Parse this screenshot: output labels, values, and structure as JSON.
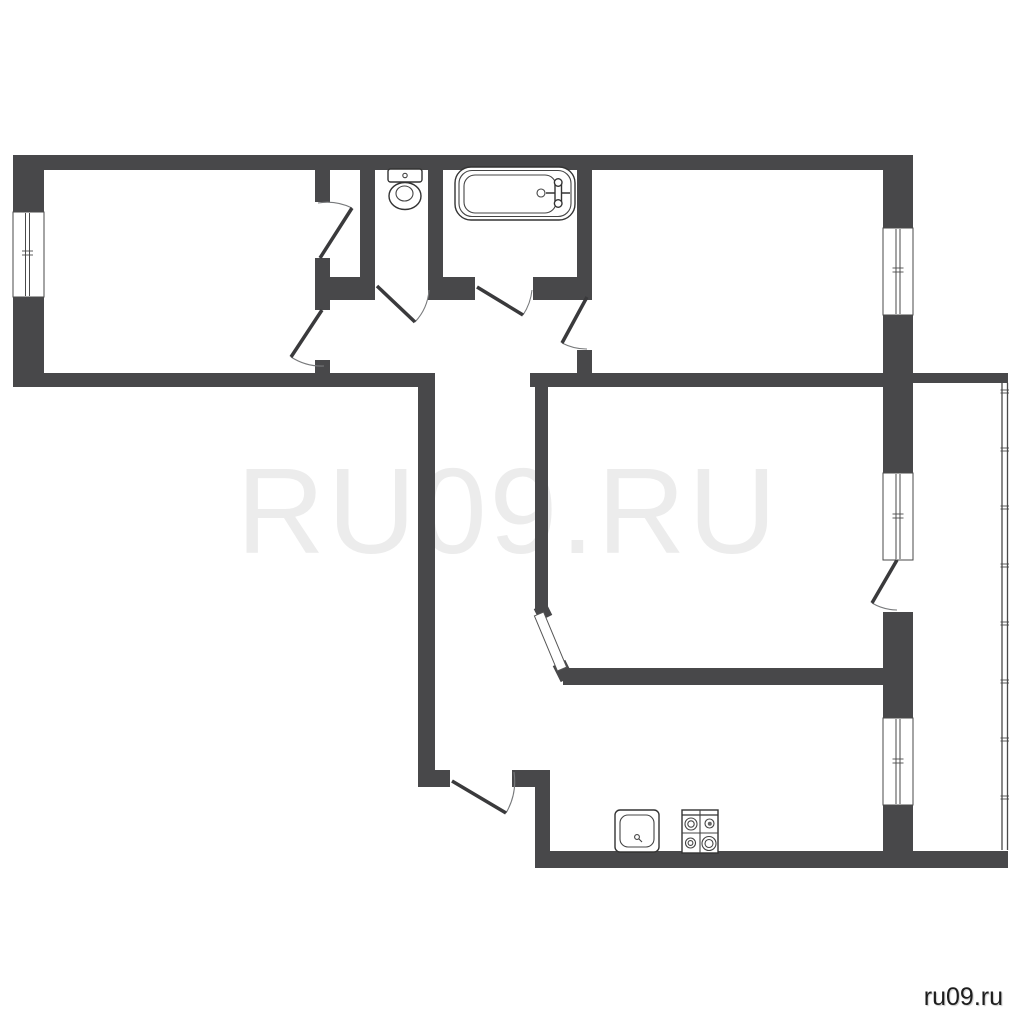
{
  "watermark": {
    "text": "RU09.RU",
    "color": "#ececec"
  },
  "site_label": {
    "text": "ru09.ru",
    "color": "#1d1d1d"
  },
  "colors": {
    "background": "#ffffff",
    "wall": "#48484a",
    "thin_line": "#444444"
  },
  "plan": {
    "styles": {
      "wall": {
        "fill": "#48484a"
      },
      "wallline": {
        "stroke": "#48484a",
        "stroke-width": 14,
        "fill": "none"
      },
      "win": {
        "fill": "#ffffff",
        "stroke": "#4a4a4a",
        "stroke-width": 1
      },
      "glass": {
        "stroke": "#4a4a4a",
        "stroke-width": 1,
        "fill": "none"
      },
      "tickline": {
        "stroke": "#4a4a4a",
        "stroke-width": 0.9,
        "fill": "none"
      },
      "leaf": {
        "stroke": "#3a3a3c",
        "stroke-width": 3.5,
        "fill": "none"
      },
      "arc": {
        "stroke": "#77797b",
        "stroke-width": 1.1,
        "fill": "none"
      },
      "strip": {
        "fill": "#ffffff",
        "stroke": "#555555",
        "stroke-width": 1
      },
      "fix": {
        "fill": "#ffffff",
        "stroke": "#333333",
        "stroke-width": 1.4
      },
      "fixthin": {
        "fill": "none",
        "stroke": "#444444",
        "stroke-width": 1.1
      },
      "fixline": {
        "stroke": "#333333",
        "stroke-width": 1.4,
        "fill": "none"
      },
      "fixdot": {
        "fill": "#666666",
        "stroke": "none"
      },
      "rail": {
        "stroke": "#4a4a4a",
        "stroke-width": 1.3,
        "fill": "none"
      }
    },
    "railing": {
      "x1": 1002,
      "x2": 1007.5,
      "y1": 383,
      "y2": 850,
      "tick_x": 1000.5,
      "tick_w": 8.5,
      "tick_gap": 3,
      "ticks": [
        390,
        448,
        506,
        564,
        622,
        680,
        738,
        796
      ]
    },
    "shapes": [
      {
        "t": "rect",
        "c": "wall",
        "n": "wall-top",
        "x": 13,
        "y": 155,
        "w": 900,
        "h": 15
      },
      {
        "t": "rect",
        "c": "wall",
        "n": "wall-left-upper",
        "x": 13,
        "y": 155,
        "w": 31,
        "h": 57
      },
      {
        "t": "rect",
        "c": "wall",
        "n": "wall-left-lower",
        "x": 13,
        "y": 297,
        "w": 31,
        "h": 90
      },
      {
        "t": "rect",
        "c": "wall",
        "n": "wall-room1-bottom",
        "x": 13,
        "y": 373,
        "w": 422,
        "h": 14
      },
      {
        "t": "rect",
        "c": "wall",
        "n": "wall-right-1",
        "x": 883,
        "y": 155,
        "w": 30,
        "h": 73
      },
      {
        "t": "rect",
        "c": "wall",
        "n": "wall-right-2",
        "x": 883,
        "y": 315,
        "w": 30,
        "h": 158
      },
      {
        "t": "rect",
        "c": "wall",
        "n": "wall-right-3",
        "x": 883,
        "y": 612,
        "w": 30,
        "h": 106
      },
      {
        "t": "rect",
        "c": "wall",
        "n": "wall-right-4",
        "x": 883,
        "y": 805,
        "w": 30,
        "h": 63
      },
      {
        "t": "rect",
        "c": "wall",
        "n": "wall-kitchen-bottom",
        "x": 535,
        "y": 851,
        "w": 473,
        "h": 17
      },
      {
        "t": "rect",
        "c": "wall",
        "n": "wall-hall-left",
        "x": 418,
        "y": 387,
        "w": 17,
        "h": 383
      },
      {
        "t": "rect",
        "c": "wall",
        "n": "wall-hall-bottom-a",
        "x": 418,
        "y": 770,
        "w": 32,
        "h": 17
      },
      {
        "t": "rect",
        "c": "wall",
        "n": "wall-hall-bottom-b",
        "x": 512,
        "y": 770,
        "w": 38,
        "h": 17
      },
      {
        "t": "rect",
        "c": "wall",
        "n": "wall-kitchen-left",
        "x": 535,
        "y": 787,
        "w": 15,
        "h": 64
      },
      {
        "t": "rect",
        "c": "wall",
        "n": "wall-room1-right-a",
        "x": 315,
        "y": 170,
        "w": 15,
        "h": 32
      },
      {
        "t": "rect",
        "c": "wall",
        "n": "wall-room1-right-b",
        "x": 315,
        "y": 258,
        "w": 15,
        "h": 52
      },
      {
        "t": "rect",
        "c": "wall",
        "n": "wall-room1-right-c",
        "x": 315,
        "y": 360,
        "w": 15,
        "h": 13
      },
      {
        "t": "rect",
        "c": "wall",
        "n": "wall-hall-top-a",
        "x": 315,
        "y": 277,
        "w": 60,
        "h": 23
      },
      {
        "t": "rect",
        "c": "wall",
        "n": "wall-hall-top-b",
        "x": 428,
        "y": 277,
        "w": 47,
        "h": 23
      },
      {
        "t": "rect",
        "c": "wall",
        "n": "wall-hall-top-c",
        "x": 533,
        "y": 277,
        "w": 59,
        "h": 23
      },
      {
        "t": "rect",
        "c": "wall",
        "n": "wall-wc-left",
        "x": 360,
        "y": 170,
        "w": 15,
        "h": 107
      },
      {
        "t": "rect",
        "c": "wall",
        "n": "wall-wc-right",
        "x": 428,
        "y": 170,
        "w": 15,
        "h": 107
      },
      {
        "t": "rect",
        "c": "wall",
        "n": "wall-room2-left-a",
        "x": 577,
        "y": 170,
        "w": 15,
        "h": 125
      },
      {
        "t": "rect",
        "c": "wall",
        "n": "wall-room2-left-b",
        "x": 577,
        "y": 350,
        "w": 15,
        "h": 23
      },
      {
        "t": "rect",
        "c": "wall",
        "n": "wall-livingroom-top",
        "x": 530,
        "y": 373,
        "w": 353,
        "h": 14
      },
      {
        "t": "rect",
        "c": "wall",
        "n": "wall-balcony-top",
        "x": 913,
        "y": 373,
        "w": 95,
        "h": 10
      },
      {
        "t": "rect",
        "c": "wall",
        "n": "wall-livingroom-left",
        "x": 535,
        "y": 387,
        "w": 13,
        "h": 225
      },
      {
        "t": "rect",
        "c": "wall",
        "n": "wall-livingroom-bottom",
        "x": 563,
        "y": 668,
        "w": 320,
        "h": 17
      },
      {
        "t": "line",
        "c": "wallline",
        "n": "wall-diagonal-cap-top",
        "x1": 540,
        "y1": 606,
        "x2": 546,
        "y2": 618
      },
      {
        "t": "line",
        "c": "wallline",
        "n": "wall-diagonal-cap-bottom",
        "x1": 559,
        "y1": 663,
        "x2": 567,
        "y2": 679
      },
      {
        "t": "rect",
        "c": "win",
        "n": "window-room1",
        "x": 13,
        "y": 212,
        "w": 31,
        "h": 85
      },
      {
        "t": "line",
        "c": "glass",
        "n": "window-room1-glass",
        "x1": 25.5,
        "y1": 213,
        "x2": 25.5,
        "y2": 296
      },
      {
        "t": "line",
        "c": "glass",
        "n": "window-room1-glass",
        "x1": 29.5,
        "y1": 213,
        "x2": 29.5,
        "y2": 296
      },
      {
        "t": "line",
        "c": "tickline",
        "n": "window-room1-tick",
        "x1": 22,
        "y1": 251,
        "x2": 33,
        "y2": 251
      },
      {
        "t": "line",
        "c": "tickline",
        "n": "window-room1-tick",
        "x1": 22,
        "y1": 255,
        "x2": 33,
        "y2": 255
      },
      {
        "t": "rect",
        "c": "win",
        "n": "window-room2",
        "x": 883,
        "y": 228,
        "w": 30,
        "h": 87
      },
      {
        "t": "line",
        "c": "glass",
        "n": "window-room2-glass",
        "x1": 896,
        "y1": 229,
        "x2": 896,
        "y2": 314
      },
      {
        "t": "line",
        "c": "glass",
        "n": "window-room2-glass",
        "x1": 900,
        "y1": 229,
        "x2": 900,
        "y2": 314
      },
      {
        "t": "line",
        "c": "tickline",
        "n": "window-room2-tick",
        "x1": 892.5,
        "y1": 268,
        "x2": 903.5,
        "y2": 268
      },
      {
        "t": "line",
        "c": "tickline",
        "n": "window-room2-tick",
        "x1": 892.5,
        "y1": 272,
        "x2": 903.5,
        "y2": 272
      },
      {
        "t": "rect",
        "c": "win",
        "n": "window-livingroom",
        "x": 883,
        "y": 473,
        "w": 30,
        "h": 87
      },
      {
        "t": "line",
        "c": "glass",
        "n": "window-livingroom-glass",
        "x1": 896,
        "y1": 474,
        "x2": 896,
        "y2": 559
      },
      {
        "t": "line",
        "c": "glass",
        "n": "window-livingroom-glass",
        "x1": 900,
        "y1": 474,
        "x2": 900,
        "y2": 559
      },
      {
        "t": "line",
        "c": "tickline",
        "n": "window-livingroom-tick",
        "x1": 892.5,
        "y1": 514,
        "x2": 903.5,
        "y2": 514
      },
      {
        "t": "line",
        "c": "tickline",
        "n": "window-livingroom-tick",
        "x1": 892.5,
        "y1": 518,
        "x2": 903.5,
        "y2": 518
      },
      {
        "t": "rect",
        "c": "win",
        "n": "window-kitchen",
        "x": 883,
        "y": 718,
        "w": 30,
        "h": 87
      },
      {
        "t": "line",
        "c": "glass",
        "n": "window-kitchen-glass",
        "x1": 896,
        "y1": 719,
        "x2": 896,
        "y2": 804
      },
      {
        "t": "line",
        "c": "glass",
        "n": "window-kitchen-glass",
        "x1": 900,
        "y1": 719,
        "x2": 900,
        "y2": 804
      },
      {
        "t": "line",
        "c": "tickline",
        "n": "window-kitchen-tick",
        "x1": 892.5,
        "y1": 759,
        "x2": 903.5,
        "y2": 759
      },
      {
        "t": "line",
        "c": "tickline",
        "n": "window-kitchen-tick",
        "x1": 892.5,
        "y1": 763,
        "x2": 903.5,
        "y2": 763
      },
      {
        "t": "path",
        "c": "arc",
        "n": "door-closet-arc",
        "d": "M352,208 A57,57 0 0 0 318,203"
      },
      {
        "t": "line",
        "c": "leaf",
        "n": "door-closet-leaf",
        "x1": 320,
        "y1": 258,
        "x2": 352,
        "y2": 208
      },
      {
        "t": "path",
        "c": "arc",
        "n": "door-room1-arc",
        "d": "M291,357 A56.5,56.5 0 0 0 324,366"
      },
      {
        "t": "line",
        "c": "leaf",
        "n": "door-room1-leaf",
        "x1": 322,
        "y1": 310,
        "x2": 291,
        "y2": 357
      },
      {
        "t": "path",
        "c": "arc",
        "n": "door-wc-arc",
        "d": "M415,322 A52,52 0 0 0 429,290"
      },
      {
        "t": "line",
        "c": "leaf",
        "n": "door-wc-leaf",
        "x1": 377,
        "y1": 286,
        "x2": 415,
        "y2": 322
      },
      {
        "t": "path",
        "c": "arc",
        "n": "door-bath-arc",
        "d": "M523,315 A55,55 0 0 0 532,290"
      },
      {
        "t": "line",
        "c": "leaf",
        "n": "door-bath-leaf",
        "x1": 477,
        "y1": 287,
        "x2": 523,
        "y2": 315
      },
      {
        "t": "path",
        "c": "arc",
        "n": "door-room2-arc",
        "d": "M562,343 A52.5,52.5 0 0 0 587,349"
      },
      {
        "t": "line",
        "c": "leaf",
        "n": "door-room2-leaf",
        "x1": 587,
        "y1": 297,
        "x2": 562,
        "y2": 343
      },
      {
        "t": "path",
        "c": "arc",
        "n": "door-balcony-arc",
        "d": "M872,603 A50,50 0 0 0 897,610"
      },
      {
        "t": "line",
        "c": "leaf",
        "n": "door-balcony-leaf",
        "x1": 897,
        "y1": 560,
        "x2": 872,
        "y2": 603
      },
      {
        "t": "path",
        "c": "arc",
        "n": "door-entry-arc",
        "d": "M506,813 A63,63 0 0 0 514,772"
      },
      {
        "t": "line",
        "c": "leaf",
        "n": "door-entry-leaf",
        "x1": 452,
        "y1": 781,
        "x2": 506,
        "y2": 813
      },
      {
        "t": "poly",
        "c": "strip",
        "n": "door-livingroom-diagonal",
        "pts": "534.4,615.9 543.6,612.1 566.6,667.1 557.4,670.9"
      },
      {
        "t": "rrect",
        "c": "fix",
        "n": "toilet-tank",
        "x": 388,
        "y": 169,
        "w": 34,
        "h": 13,
        "rx": 2.5
      },
      {
        "t": "circle",
        "c": "fixthin",
        "n": "toilet-button",
        "cx": 405,
        "cy": 175.5,
        "r": 2.2
      },
      {
        "t": "ellipse",
        "c": "fix",
        "n": "toilet-bowl",
        "cx": 405,
        "cy": 196,
        "rx": 16,
        "ry": 13.5
      },
      {
        "t": "ellipse",
        "c": "fixthin",
        "n": "toilet-bowl-inner",
        "cx": 404.5,
        "cy": 193.5,
        "rx": 8.5,
        "ry": 7.5
      },
      {
        "t": "rrect",
        "c": "fix",
        "n": "bathtub-outer",
        "x": 455,
        "y": 167,
        "w": 120,
        "h": 53,
        "rx": 16
      },
      {
        "t": "rrect",
        "c": "fixthin",
        "n": "bathtub-rim",
        "x": 459,
        "y": 170.5,
        "w": 112,
        "h": 46,
        "rx": 13
      },
      {
        "t": "rrect",
        "c": "fixthin",
        "n": "bathtub-basin",
        "x": 464,
        "y": 175,
        "w": 92,
        "h": 38,
        "rx": 11
      },
      {
        "t": "circle",
        "c": "fixthin",
        "n": "bathtub-drain",
        "cx": 541,
        "cy": 193,
        "r": 4
      },
      {
        "t": "line",
        "c": "fixline",
        "n": "bathtub-tap-spout",
        "x1": 546,
        "y1": 193,
        "x2": 570,
        "y2": 193,
        "sw": 1.6
      },
      {
        "t": "rrect",
        "c": "fix",
        "n": "bathtub-tap-body",
        "x": 555,
        "y": 180,
        "w": 6.5,
        "h": 26,
        "rx": 3
      },
      {
        "t": "circle",
        "c": "fix",
        "n": "bathtub-tap-knob",
        "cx": 558.2,
        "cy": 182.5,
        "r": 3.8
      },
      {
        "t": "circle",
        "c": "fix",
        "n": "bathtub-tap-knob",
        "cx": 558.2,
        "cy": 203.5,
        "r": 3.8
      },
      {
        "t": "rrect",
        "c": "fix",
        "n": "kitchen-sink",
        "x": 615,
        "y": 810,
        "w": 44,
        "h": 42,
        "rx": 5
      },
      {
        "t": "rrect",
        "c": "fixthin",
        "n": "kitchen-sink-basin",
        "x": 620,
        "y": 815,
        "w": 34,
        "h": 32,
        "rx": 8
      },
      {
        "t": "circle",
        "c": "fixthin",
        "n": "kitchen-sink-drain",
        "cx": 637,
        "cy": 837,
        "r": 2.4
      },
      {
        "t": "line",
        "c": "fixthin",
        "n": "kitchen-sink-drain-line",
        "x1": 638.5,
        "y1": 838.5,
        "x2": 642,
        "y2": 842
      },
      {
        "t": "rect",
        "c": "fix",
        "n": "stove-body",
        "x": 682,
        "y": 810,
        "w": 36,
        "h": 43
      },
      {
        "t": "line",
        "c": "fixline",
        "n": "stove-top-edge",
        "x1": 682,
        "y1": 815,
        "x2": 718,
        "y2": 815,
        "sw": 1.2
      },
      {
        "t": "line",
        "c": "fixthin",
        "n": "stove-divider-v",
        "x1": 700,
        "y1": 810,
        "x2": 700,
        "y2": 853
      },
      {
        "t": "line",
        "c": "fixthin",
        "n": "stove-divider-h",
        "x1": 682,
        "y1": 833,
        "x2": 718,
        "y2": 833
      },
      {
        "t": "circle",
        "c": "fixthin",
        "n": "stove-burner",
        "cx": 691,
        "cy": 824,
        "r": 6
      },
      {
        "t": "circle",
        "c": "fixthin",
        "n": "stove-burner",
        "cx": 691,
        "cy": 824,
        "r": 3.2
      },
      {
        "t": "circle",
        "c": "fixthin",
        "n": "stove-burner",
        "cx": 709.5,
        "cy": 823.5,
        "r": 4.5
      },
      {
        "t": "circle",
        "c": "fixdot",
        "n": "stove-burner-dot",
        "cx": 709.8,
        "cy": 823.8,
        "r": 2
      },
      {
        "t": "circle",
        "c": "fixthin",
        "n": "stove-burner",
        "cx": 690.5,
        "cy": 843,
        "r": 5
      },
      {
        "t": "circle",
        "c": "fixthin",
        "n": "stove-burner",
        "cx": 690.5,
        "cy": 843,
        "r": 2.4
      },
      {
        "t": "circle",
        "c": "fixthin",
        "n": "stove-burner",
        "cx": 709,
        "cy": 843.5,
        "r": 7
      },
      {
        "t": "circle",
        "c": "fixthin",
        "n": "stove-burner",
        "cx": 709,
        "cy": 843.5,
        "r": 4
      }
    ]
  }
}
